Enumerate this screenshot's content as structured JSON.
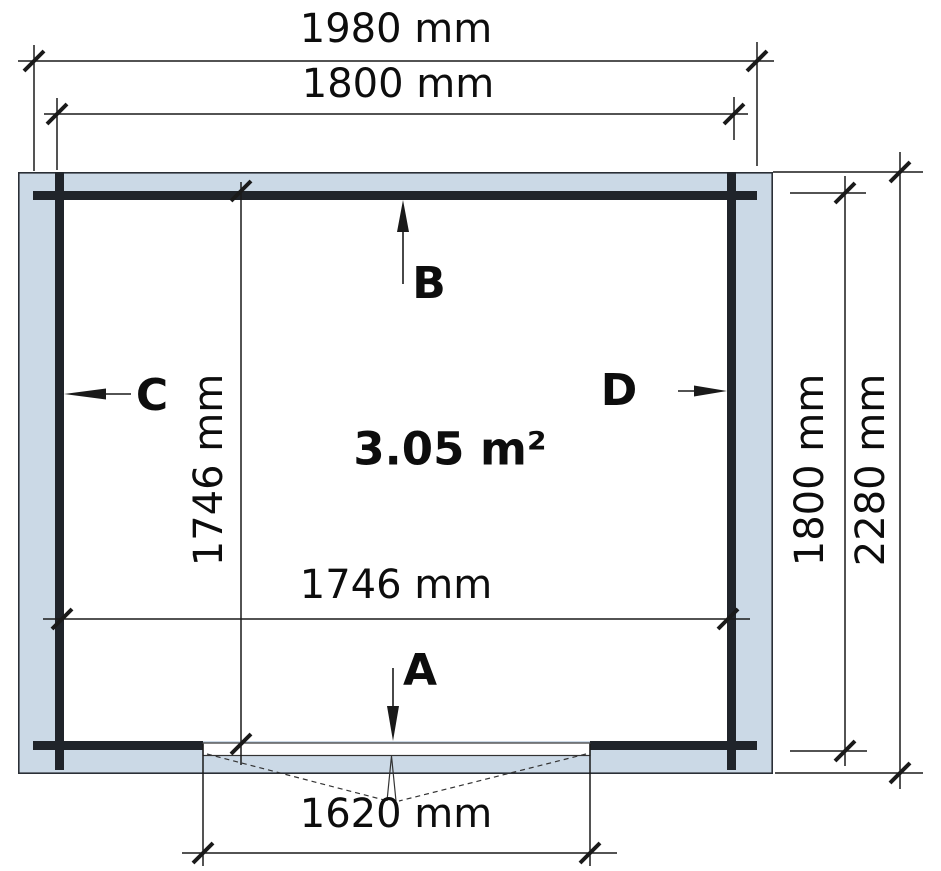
{
  "colors": {
    "wall_fill": "#cbd9e6",
    "wood": "#20242a",
    "line": "#1a1a1a",
    "thin": "#333333",
    "text": "#0d0d0d",
    "bg": "#ffffff"
  },
  "plan": {
    "area_label": "3.05 m²",
    "dims": {
      "top_outer": "1980 mm",
      "top_inner": "1800 mm",
      "interior_width": "1746 mm",
      "interior_depth": "1746 mm",
      "side_inner": "1800 mm",
      "side_outer": "2280 mm",
      "door": "1620 mm"
    },
    "markers": {
      "front": "A",
      "back": "B",
      "left": "C",
      "right": "D"
    }
  }
}
